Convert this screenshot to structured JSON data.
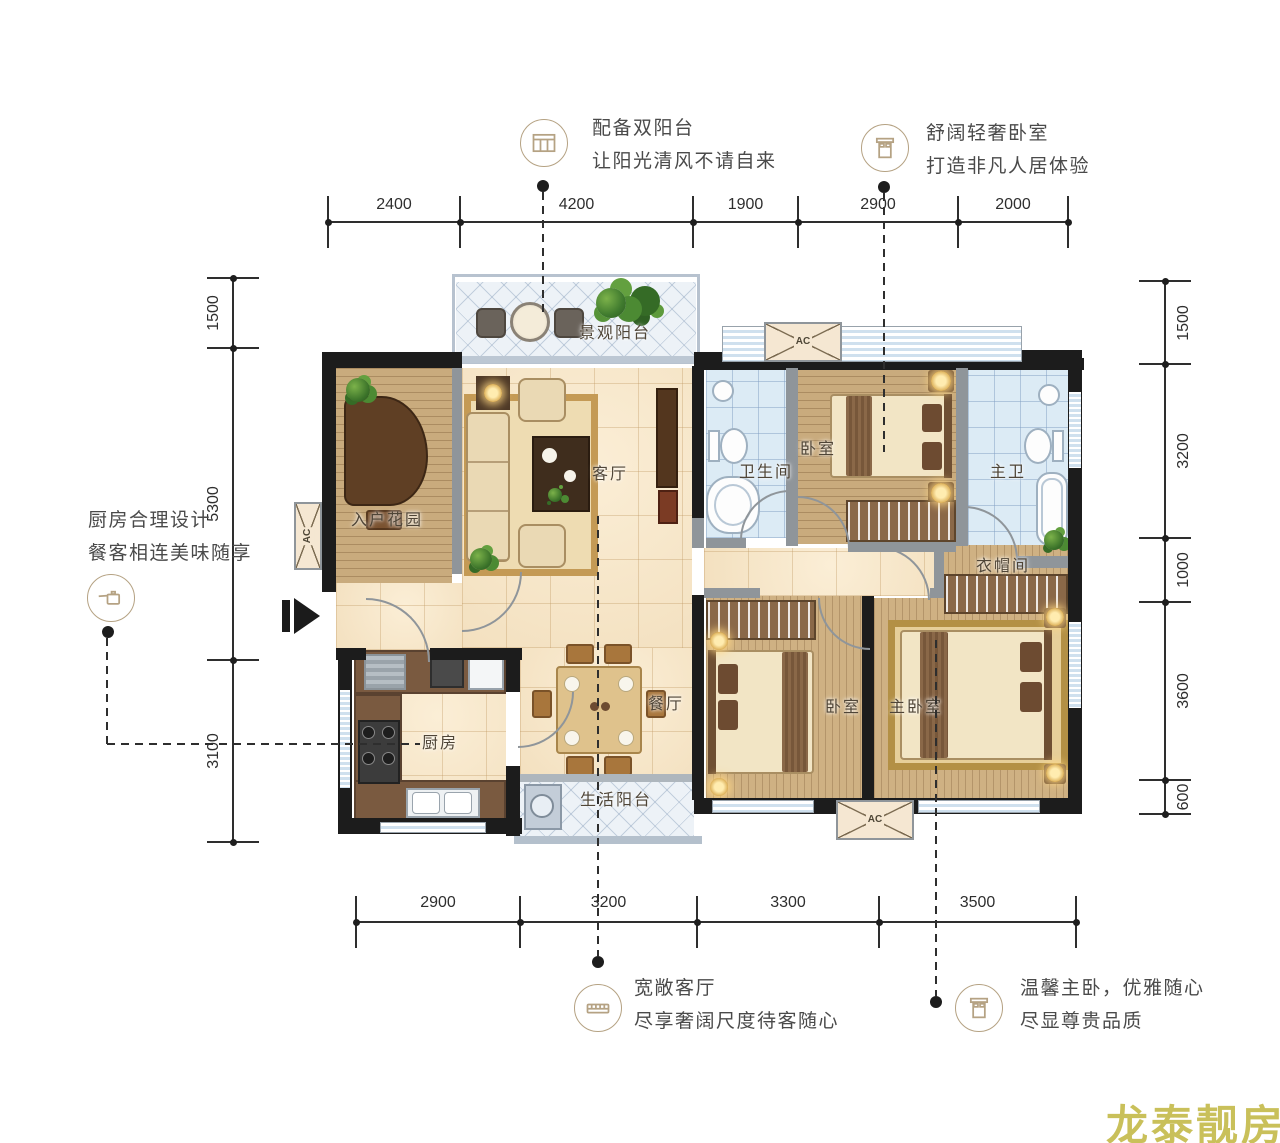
{
  "callouts": {
    "double_balcony": {
      "line1": "配备双阳台",
      "line2": "让阳光清风不请自来"
    },
    "cozy_bedroom": {
      "line1": "舒阔轻奢卧室",
      "line2": "打造非凡人居体验"
    },
    "kitchen_design": {
      "line1": "厨房合理设计",
      "line2": "餐客相连美味随享"
    },
    "spacious_living": {
      "line1": "宽敞客厅",
      "line2": "尽享奢阔尺度待客随心"
    },
    "warm_master": {
      "line1": "温馨主卧，优雅随心",
      "line2": "尽显尊贵品质"
    }
  },
  "dimensions": {
    "top": [
      "2400",
      "4200",
      "1900",
      "2900",
      "2000"
    ],
    "bottom": [
      "2900",
      "3200",
      "3300",
      "3500"
    ],
    "left": [
      "1500",
      "5300",
      "3100"
    ],
    "right": [
      "1500",
      "3200",
      "1000",
      "3600",
      "600"
    ]
  },
  "rooms": {
    "view_balcony": "景观阳台",
    "entry_garden": "入户花园",
    "living_room": "客厅",
    "bathroom": "卫生间",
    "bedroom_top": "卧室",
    "master_bath": "主卫",
    "cloakroom": "衣帽间",
    "kitchen": "厨房",
    "dining_room": "餐厅",
    "service_balcony": "生活阳台",
    "bedroom_bottom": "卧室",
    "master_bedroom": "主卧室"
  },
  "labels": {
    "ac": "AC"
  },
  "watermark": "龙泰靓房"
}
